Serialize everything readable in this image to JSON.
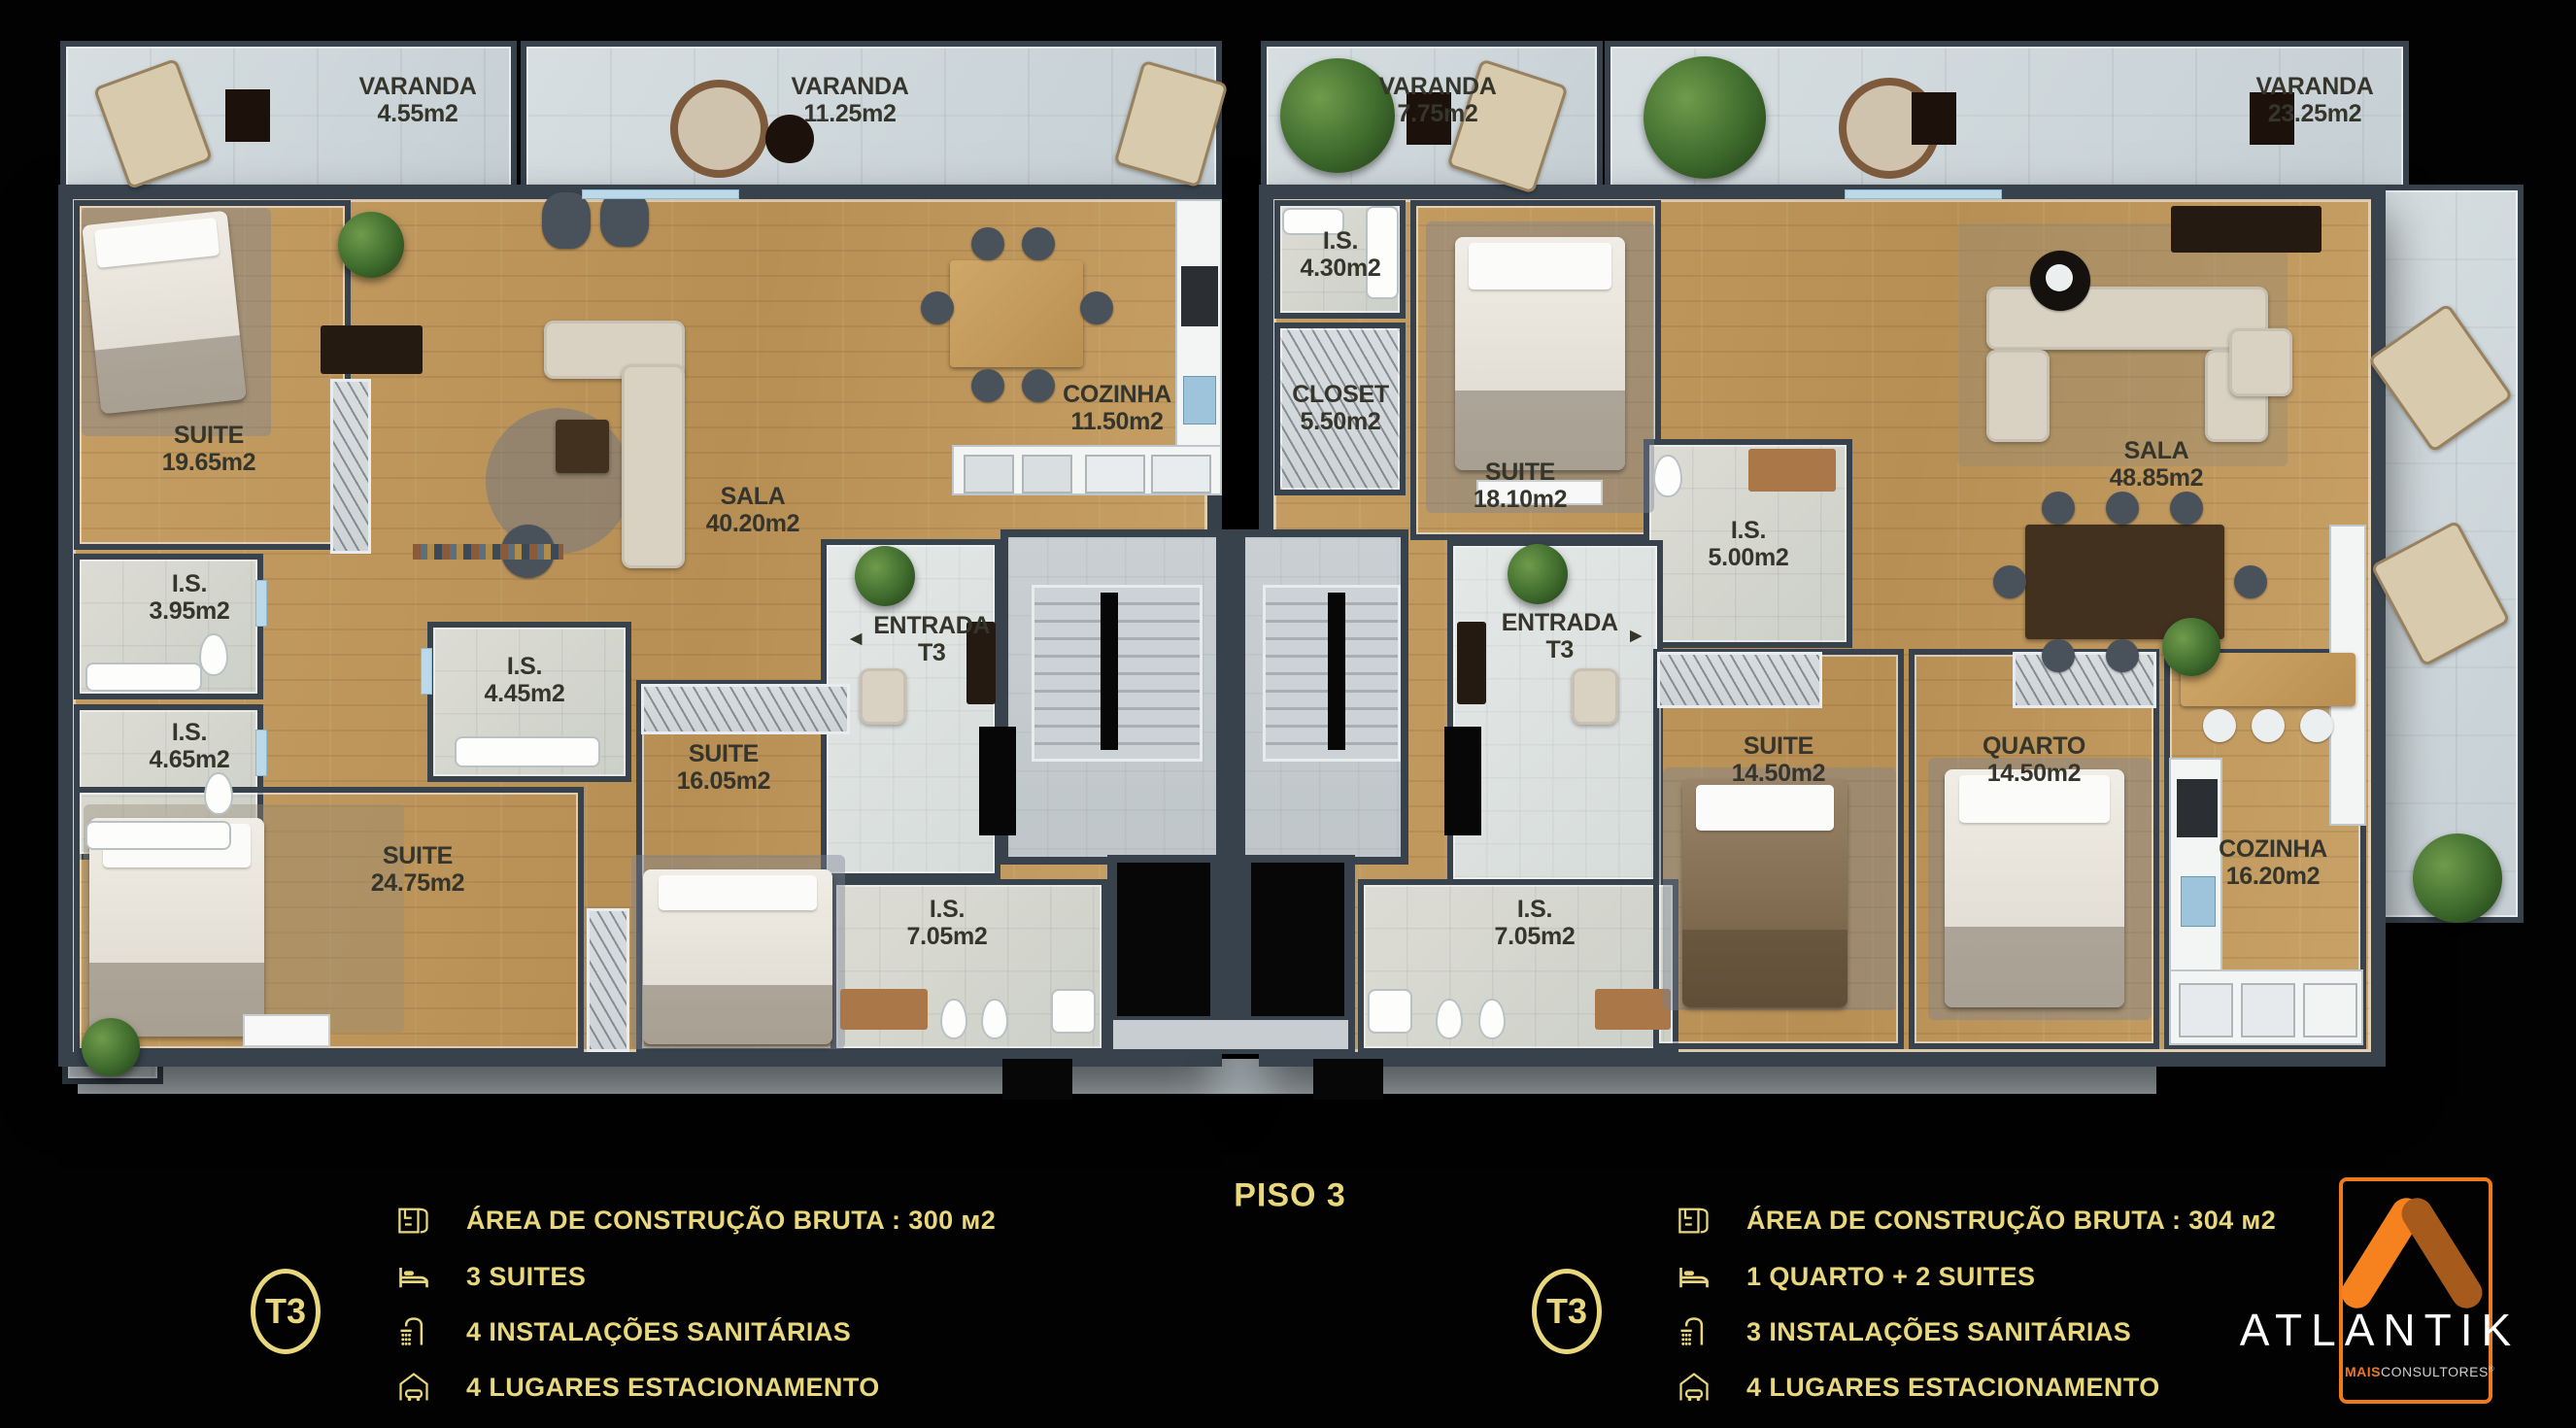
{
  "floor": {
    "title": "PISO 3"
  },
  "rooms": {
    "varanda_455": {
      "name": "VARANDA",
      "area": "4.55m2"
    },
    "varanda_1125": {
      "name": "VARANDA",
      "area": "11.25m2"
    },
    "varanda_775": {
      "name": "VARANDA",
      "area": "7.75m2"
    },
    "varanda_2325": {
      "name": "VARANDA",
      "area": "23.25m2"
    },
    "suite_1965": {
      "name": "SUITE",
      "area": "19.65m2"
    },
    "is_395": {
      "name": "I.S.",
      "area": "3.95m2"
    },
    "is_465": {
      "name": "I.S.",
      "area": "4.65m2"
    },
    "is_445": {
      "name": "I.S.",
      "area": "4.45m2"
    },
    "suite_2475": {
      "name": "SUITE",
      "area": "24.75m2"
    },
    "suite_1605": {
      "name": "SUITE",
      "area": "16.05m2"
    },
    "sala_4020": {
      "name": "SALA",
      "area": "40.20m2"
    },
    "cozinha_1150": {
      "name": "COZINHA",
      "area": "11.50m2"
    },
    "entrada_left": {
      "name": "ENTRADA",
      "area": "T3"
    },
    "is_705_left": {
      "name": "I.S.",
      "area": "7.05m2"
    },
    "is_430": {
      "name": "I.S.",
      "area": "4.30m2"
    },
    "closet_550": {
      "name": "CLOSET",
      "area": "5.50m2"
    },
    "suite_1810": {
      "name": "SUITE",
      "area": "18.10m2"
    },
    "is_500": {
      "name": "I.S.",
      "area": "5.00m2"
    },
    "sala_4885": {
      "name": "SALA",
      "area": "48.85m2"
    },
    "entrada_right": {
      "name": "ENTRADA",
      "area": "T3"
    },
    "is_705_right": {
      "name": "I.S.",
      "area": "7.05m2"
    },
    "suite_1450": {
      "name": "SUITE",
      "area": "14.50m2"
    },
    "quarto_1450": {
      "name": "QUARTO",
      "area": "14.50m2"
    },
    "cozinha_1620": {
      "name": "COZINHA",
      "area": "16.20m2"
    }
  },
  "icons": {
    "entrance_arrow_left": "◄",
    "entrance_arrow_right": "►"
  },
  "legend_left": {
    "badge": "T3",
    "items": [
      {
        "icon": "blueprint-icon",
        "label": "ÁREA DE CONSTRUÇÃO BRUTA :  300 м2"
      },
      {
        "icon": "bed-icon",
        "label": "3 SUITES"
      },
      {
        "icon": "shower-icon",
        "label": "4 INSTALAÇÕES SANITÁRIAS"
      },
      {
        "icon": "car-garage-icon",
        "label": "4 LUGARES ESTACIONAMENTO"
      }
    ]
  },
  "legend_right": {
    "badge": "T3",
    "items": [
      {
        "icon": "blueprint-icon",
        "label": "ÁREA DE CONSTRUÇÃO BRUTA :  304 м2"
      },
      {
        "icon": "bed-icon",
        "label": "1 QUARTO + 2 SUITES"
      },
      {
        "icon": "shower-icon",
        "label": "3 INSTALAÇÕES SANITÁRIAS"
      },
      {
        "icon": "car-garage-icon",
        "label": "4 LUGARES ESTACIONAMENTO"
      }
    ]
  },
  "brand": {
    "name": "ATLANTIK",
    "sub_bold": "MAIS",
    "sub_rest": "CONSULTORES",
    "reg": "®"
  },
  "colors": {
    "gold": "#e8d77c",
    "orange": "#f0791d",
    "orange_dark": "#a65a1b",
    "wall": "#37424d"
  }
}
